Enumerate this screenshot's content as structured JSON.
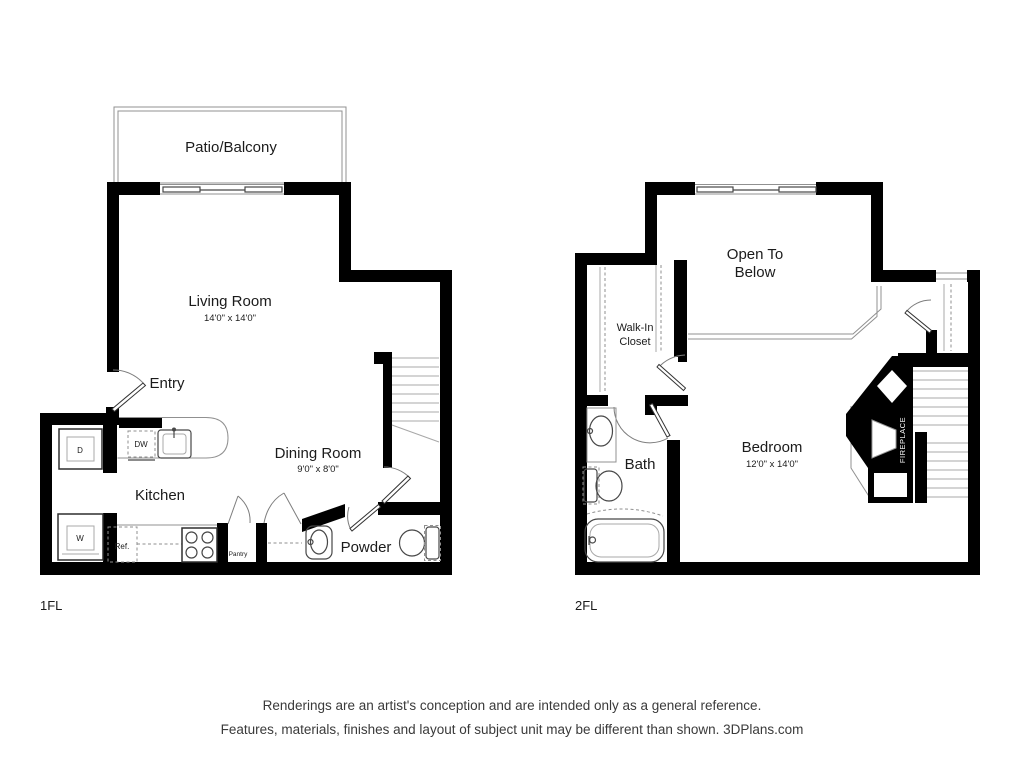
{
  "floor1": {
    "floor_label": "1FL",
    "patio": "Patio/Balcony",
    "living_room": {
      "name": "Living Room",
      "dims": "14'0\" x 14'0\""
    },
    "entry": "Entry",
    "kitchen": "Kitchen",
    "dining_room": {
      "name": "Dining Room",
      "dims": "9'0\" x 8'0\""
    },
    "powder": "Powder",
    "pantry": "Pantry",
    "appliances": {
      "dishwasher": "DW",
      "dryer": "D",
      "washer": "W",
      "refrigerator": "Ref."
    }
  },
  "floor2": {
    "floor_label": "2FL",
    "open_to_below_line1": "Open To",
    "open_to_below_line2": "Below",
    "walk_in_closet_line1": "Walk-In",
    "walk_in_closet_line2": "Closet",
    "bath": "Bath",
    "bedroom": {
      "name": "Bedroom",
      "dims": "12'0\" x 14'0\""
    },
    "fireplace": "FIREPLACE"
  },
  "footer": {
    "line1": "Renderings are an artist's conception and are intended only as a general reference.",
    "line2": "Features, materials, finishes and layout of subject unit may be different than shown. 3DPlans.com"
  },
  "colors": {
    "wall": "#000000",
    "fixture": "#474747",
    "light_line": "#a8a8a8",
    "text": "#1b1b1b"
  }
}
